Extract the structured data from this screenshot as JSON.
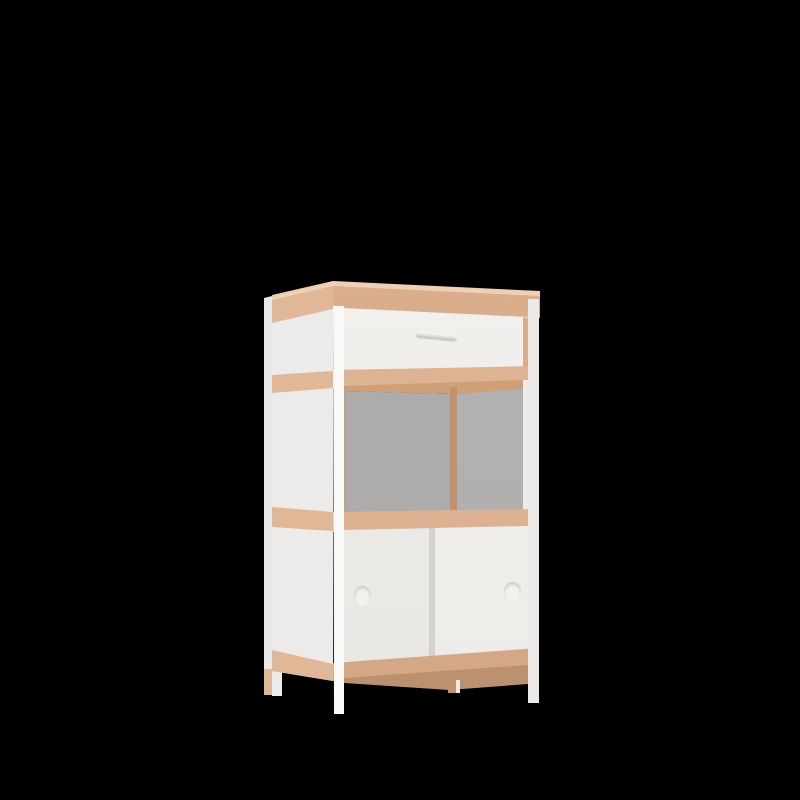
{
  "scene": {
    "type": "3d-product-render",
    "description": "Freestanding storage cabinet rendered on a black background: white slim corner posts and legs, beech-wood trim rails, a white top drawer with a small metal bar handle, an open middle compartment with grey back panels and a wooden corner upright, and two white sliding doors with round recessed finger-pull handles.",
    "background_color": "#000000"
  },
  "colors": {
    "background": "#000000",
    "wood-front": "#dcb191",
    "wood-side": "#e1b897",
    "wood-top": "#edd0b5",
    "wood-inner": "#cfa078",
    "wood-divider": "#c2916f",
    "wood-apron": "#c79a78",
    "wood-edge": "#d8ad8b",
    "gray-left": "#acaaa8",
    "gray-right": "#b1afad",
    "handle-gray": "#d5d4d2",
    "post-white": "#f7f7f6",
    "panel-white": "#efeeec"
  },
  "parts": {
    "cabinet": "white and beech cabinet",
    "drawer": "top drawer with bar handle",
    "open_shelf": "middle open compartment with grey back",
    "sliding_doors": "two white sliding doors with round finger holes",
    "legs": "four slim legs (white front, wood rear)"
  }
}
